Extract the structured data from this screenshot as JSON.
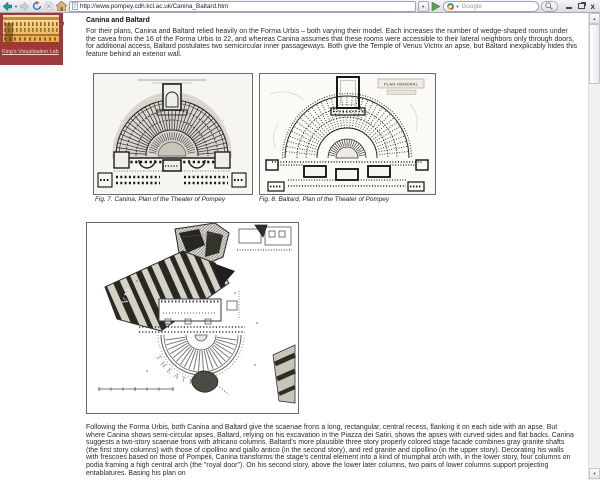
{
  "browser": {
    "url": "http://www.pompey.cdh.kcl.ac.uk/Canina_Baltard.htm",
    "search_placeholder": "Google",
    "minimize_label": "",
    "close_label": "x"
  },
  "sidebar": {
    "link_label": "King's Visualisation Lab"
  },
  "article": {
    "heading": "Canina and Baltard",
    "para1": "For their plans, Canina and Baltard relied heavily on the Forma Urbis – both varying their model. Each increases the number of wedge-shaped rooms under the cavea from the 16 of the Forma Urbis to 22, and whereas Canina assumes that these rooms were accessible to their lateral neighbors only through doors, for additional access, Baltard postulates two semicircular inner passageways. Both give the Temple of Venus Victrix an apse, but Baltard inexplicably hides this feature behind an exterior wall.",
    "fig7": {
      "caption": "Fig. 7. Canina, Plan of  the Theater of Pompey"
    },
    "fig8": {
      "caption": "Fig. 8. Baltard, Plan of  the Theater of Pompey",
      "plan_label": "PLAN GÉNÉRAL"
    },
    "fig9": {
      "caption_l1": "Fig. 9, The Forma",
      "caption_l2": "Urbis  partially restored",
      "caption_l3": "(James Packer)",
      "map_label": "THEATRVM",
      "fragment_label": "VM"
    },
    "para2": "Following the Forma Urbis, both Canina and Baltard give the scaenae frons a long, rectangular, central recess, flanking it on each side with an apse. But where Canina shows semi-circular apses, Baltard, relying on his excavation in the Piazza dei Satiri, shows the apses with curved sides and flat backs. Canina suggests a two-story scaenae frons with africano columns. Baltard's more plausible three story properly colored stage facade combines gray granite shafts (the first story columns) with those of cipollino and giallo antico (in the second story), and red granite and cipollino (in the upper story). Decorating his walls with frescoes based on those of  Pompeii, Canina transforms the stage's central element into a kind of triumphal arch with, in the lower story, four columns on podia framing a high central arch (the \"royal door\"). On his second story,  above the lower later columns, two pairs of lower columns support projecting entablatures. Basing his plan on"
  }
}
